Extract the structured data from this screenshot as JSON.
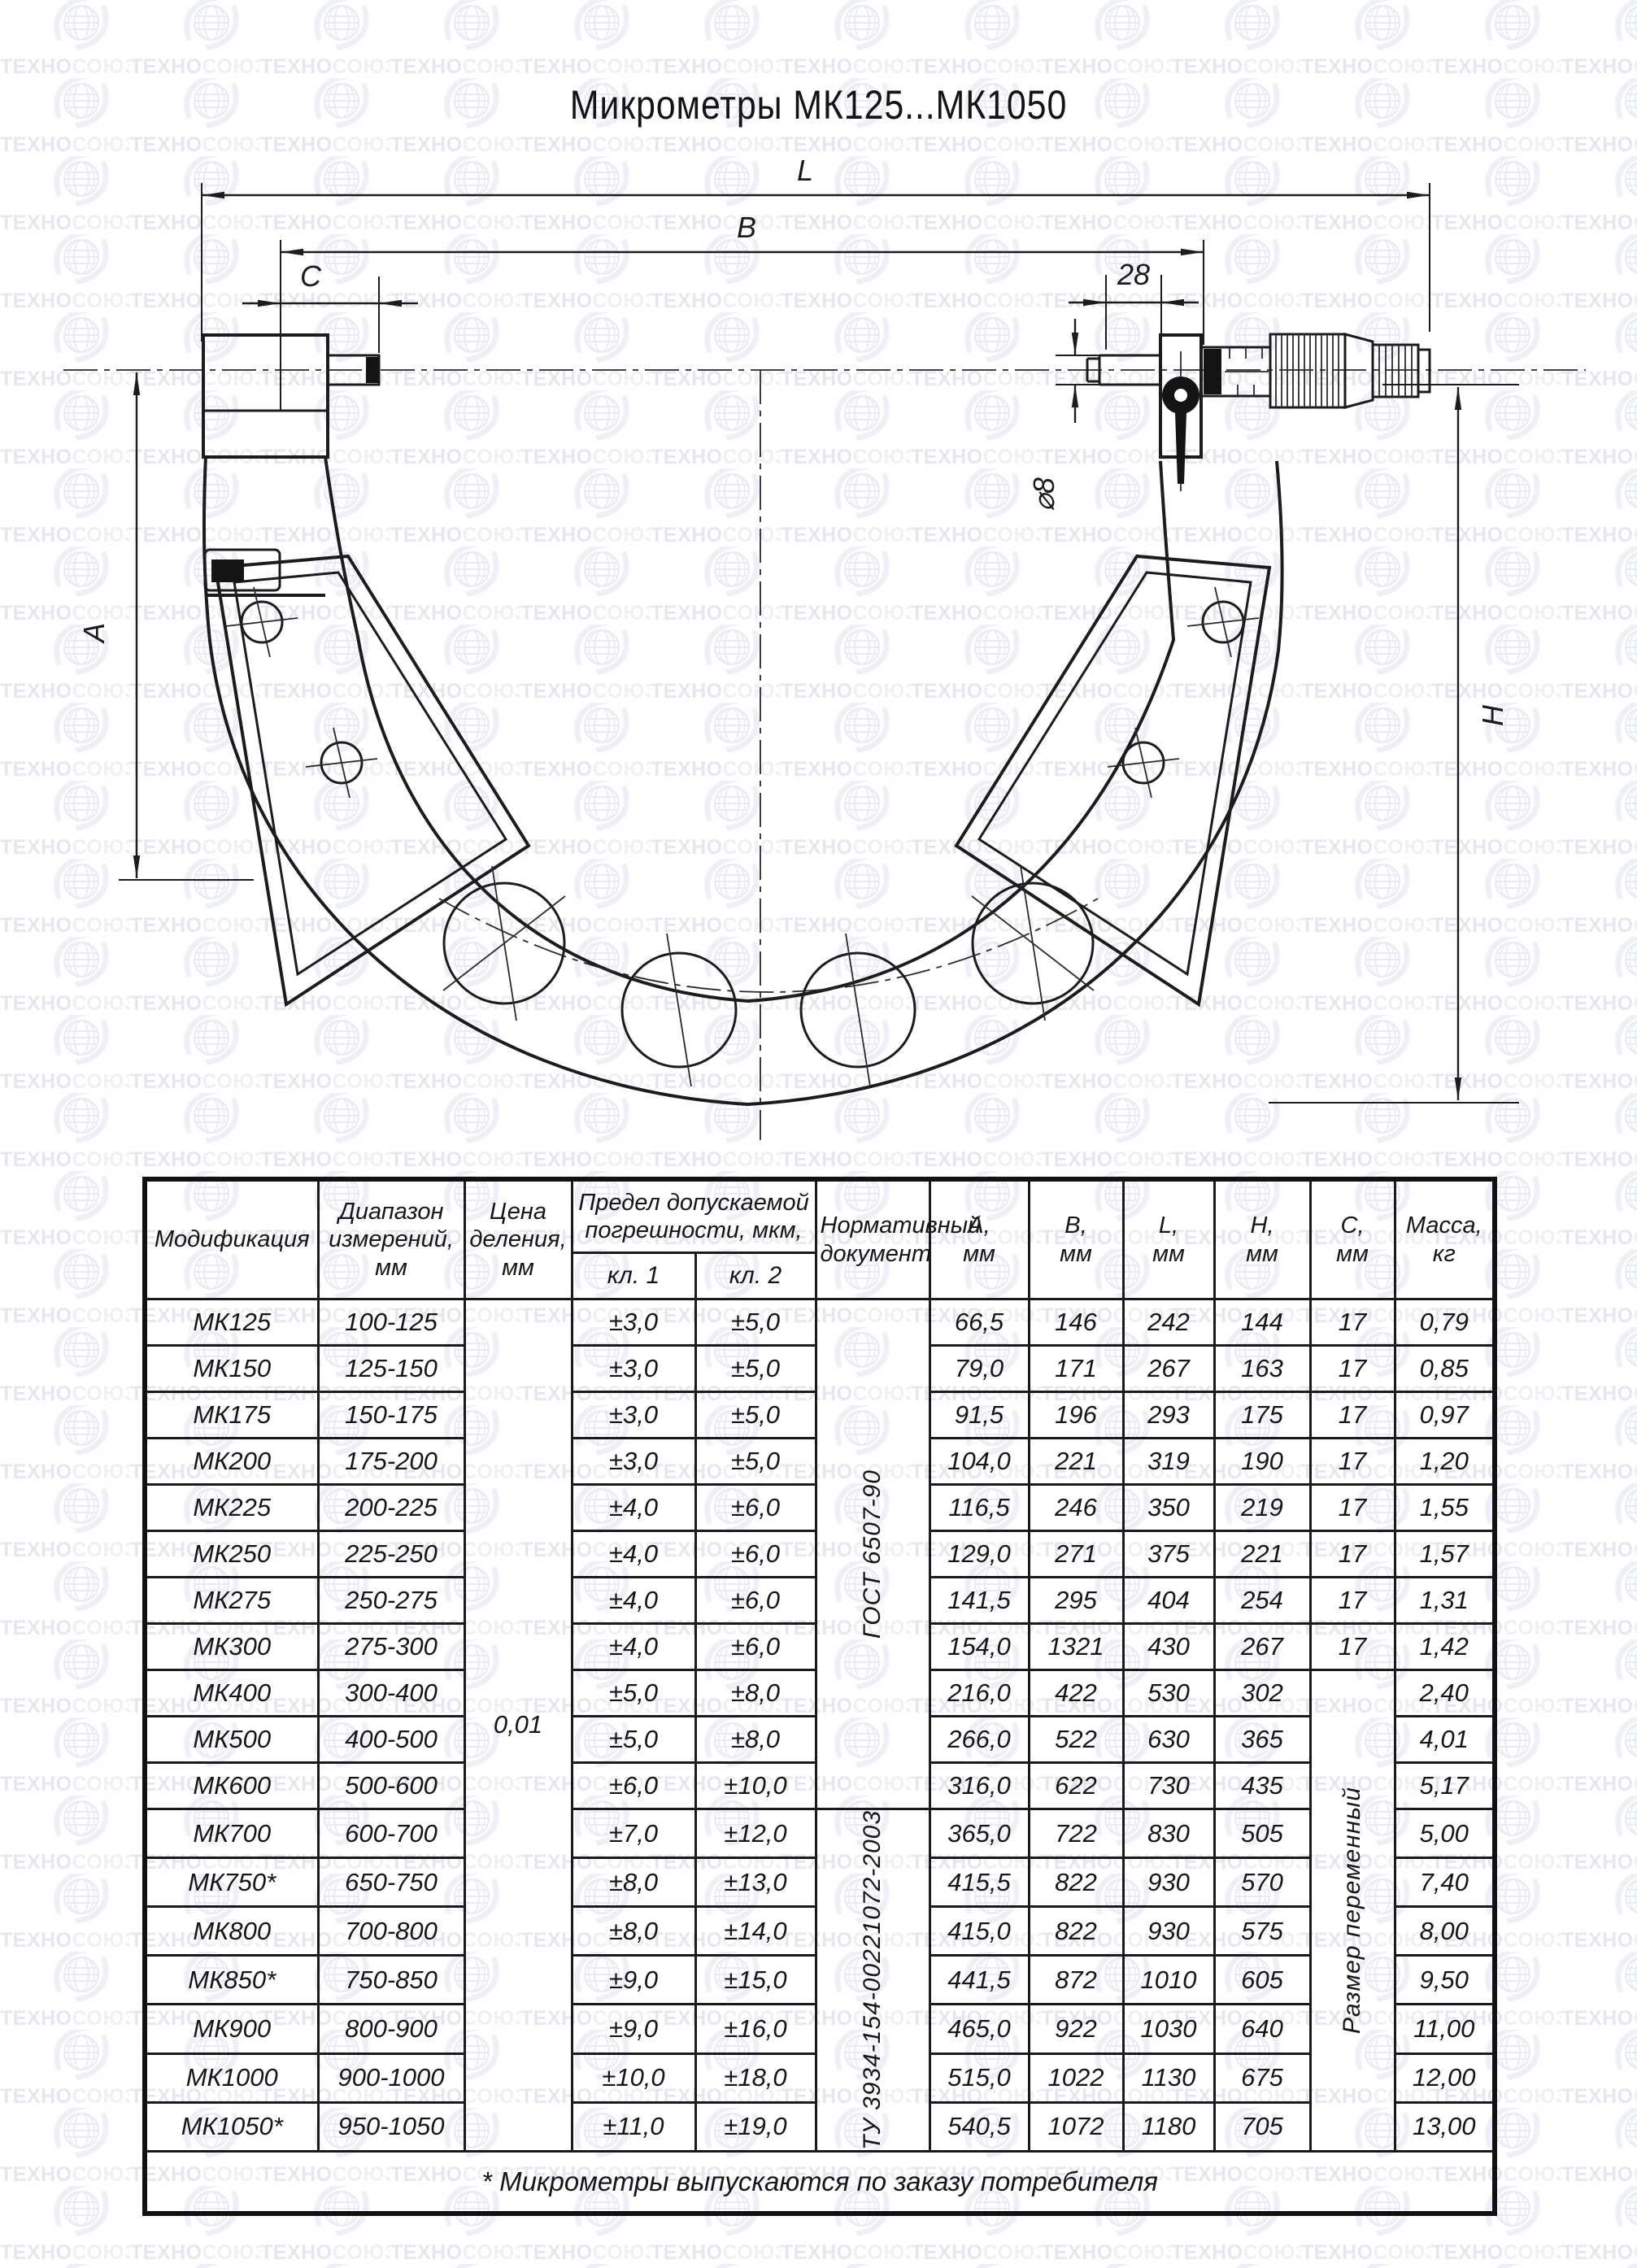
{
  "watermark": {
    "text": "ТЕХНОСОЮЗ",
    "registered": "®",
    "color_dark": "#e3e7f0",
    "color_light": "#edf0f7",
    "logo_color": "#e9ecf4"
  },
  "title": "Микрометры МК125...МК1050",
  "drawing": {
    "labels": {
      "L": "L",
      "B": "B",
      "C": "C",
      "dim28": "28",
      "dia8": "⌀8",
      "A": "A",
      "H": "H"
    }
  },
  "table": {
    "headers": {
      "model": "Модификация",
      "range": "Диапазон\nизмерений,\nмм",
      "division": "Цена\nделения,\nмм",
      "error": "Предел допускаемой\nпогрешности, мкм,",
      "kl1": "кл. 1",
      "kl2": "кл. 2",
      "doc": "Нормативный\nдокумент",
      "a": "А,\nмм",
      "b": "В,\nмм",
      "l": "L,\nмм",
      "h": "Н,\nмм",
      "c": "С,\nмм",
      "mass": "Масса,\nкг"
    },
    "merged": {
      "division_value": "0,01",
      "doc1": "ГОСТ 6507-90",
      "doc1_rows": 11,
      "doc2": "ТУ 3934-154-00221072-2003",
      "doc2_rows": 7,
      "c_variable": "Размер переменный",
      "c_variable_rows": 10
    },
    "rows": [
      {
        "model": "МК125",
        "range": "100-125",
        "kl1": "±3,0",
        "kl2": "±5,0",
        "a": "66,5",
        "b": "146",
        "l": "242",
        "h": "144",
        "c": "17",
        "mass": "0,79"
      },
      {
        "model": "МК150",
        "range": "125-150",
        "kl1": "±3,0",
        "kl2": "±5,0",
        "a": "79,0",
        "b": "171",
        "l": "267",
        "h": "163",
        "c": "17",
        "mass": "0,85"
      },
      {
        "model": "МК175",
        "range": "150-175",
        "kl1": "±3,0",
        "kl2": "±5,0",
        "a": "91,5",
        "b": "196",
        "l": "293",
        "h": "175",
        "c": "17",
        "mass": "0,97"
      },
      {
        "model": "МК200",
        "range": "175-200",
        "kl1": "±3,0",
        "kl2": "±5,0",
        "a": "104,0",
        "b": "221",
        "l": "319",
        "h": "190",
        "c": "17",
        "mass": "1,20"
      },
      {
        "model": "МК225",
        "range": "200-225",
        "kl1": "±4,0",
        "kl2": "±6,0",
        "a": "116,5",
        "b": "246",
        "l": "350",
        "h": "219",
        "c": "17",
        "mass": "1,55"
      },
      {
        "model": "МК250",
        "range": "225-250",
        "kl1": "±4,0",
        "kl2": "±6,0",
        "a": "129,0",
        "b": "271",
        "l": "375",
        "h": "221",
        "c": "17",
        "mass": "1,57"
      },
      {
        "model": "МК275",
        "range": "250-275",
        "kl1": "±4,0",
        "kl2": "±6,0",
        "a": "141,5",
        "b": "295",
        "l": "404",
        "h": "254",
        "c": "17",
        "mass": "1,31"
      },
      {
        "model": "МК300",
        "range": "275-300",
        "kl1": "±4,0",
        "kl2": "±6,0",
        "a": "154,0",
        "b": "1321",
        "l": "430",
        "h": "267",
        "c": "17",
        "mass": "1,42"
      },
      {
        "model": "МК400",
        "range": "300-400",
        "kl1": "±5,0",
        "kl2": "±8,0",
        "a": "216,0",
        "b": "422",
        "l": "530",
        "h": "302",
        "c": null,
        "mass": "2,40"
      },
      {
        "model": "МК500",
        "range": "400-500",
        "kl1": "±5,0",
        "kl2": "±8,0",
        "a": "266,0",
        "b": "522",
        "l": "630",
        "h": "365",
        "c": null,
        "mass": "4,01"
      },
      {
        "model": "МК600",
        "range": "500-600",
        "kl1": "±6,0",
        "kl2": "±10,0",
        "a": "316,0",
        "b": "622",
        "l": "730",
        "h": "435",
        "c": null,
        "mass": "5,17"
      },
      {
        "model": "МК700",
        "range": "600-700",
        "kl1": "±7,0",
        "kl2": "±12,0",
        "a": "365,0",
        "b": "722",
        "l": "830",
        "h": "505",
        "c": null,
        "mass": "5,00"
      },
      {
        "model": "МК750*",
        "range": "650-750",
        "kl1": "±8,0",
        "kl2": "±13,0",
        "a": "415,5",
        "b": "822",
        "l": "930",
        "h": "570",
        "c": null,
        "mass": "7,40"
      },
      {
        "model": "МК800",
        "range": "700-800",
        "kl1": "±8,0",
        "kl2": "±14,0",
        "a": "415,0",
        "b": "822",
        "l": "930",
        "h": "575",
        "c": null,
        "mass": "8,00"
      },
      {
        "model": "МК850*",
        "range": "750-850",
        "kl1": "±9,0",
        "kl2": "±15,0",
        "a": "441,5",
        "b": "872",
        "l": "1010",
        "h": "605",
        "c": null,
        "mass": "9,50"
      },
      {
        "model": "МК900",
        "range": "800-900",
        "kl1": "±9,0",
        "kl2": "±16,0",
        "a": "465,0",
        "b": "922",
        "l": "1030",
        "h": "640",
        "c": null,
        "mass": "11,00"
      },
      {
        "model": "МК1000",
        "range": "900-1000",
        "kl1": "±10,0",
        "kl2": "±18,0",
        "a": "515,0",
        "b": "1022",
        "l": "1130",
        "h": "675",
        "c": null,
        "mass": "12,00"
      },
      {
        "model": "МК1050*",
        "range": "950-1050",
        "kl1": "±11,0",
        "kl2": "±19,0",
        "a": "540,5",
        "b": "1072",
        "l": "1180",
        "h": "705",
        "c": null,
        "mass": "13,00"
      }
    ],
    "footnote": "* Микрометры выпускаются по заказу потребителя"
  }
}
